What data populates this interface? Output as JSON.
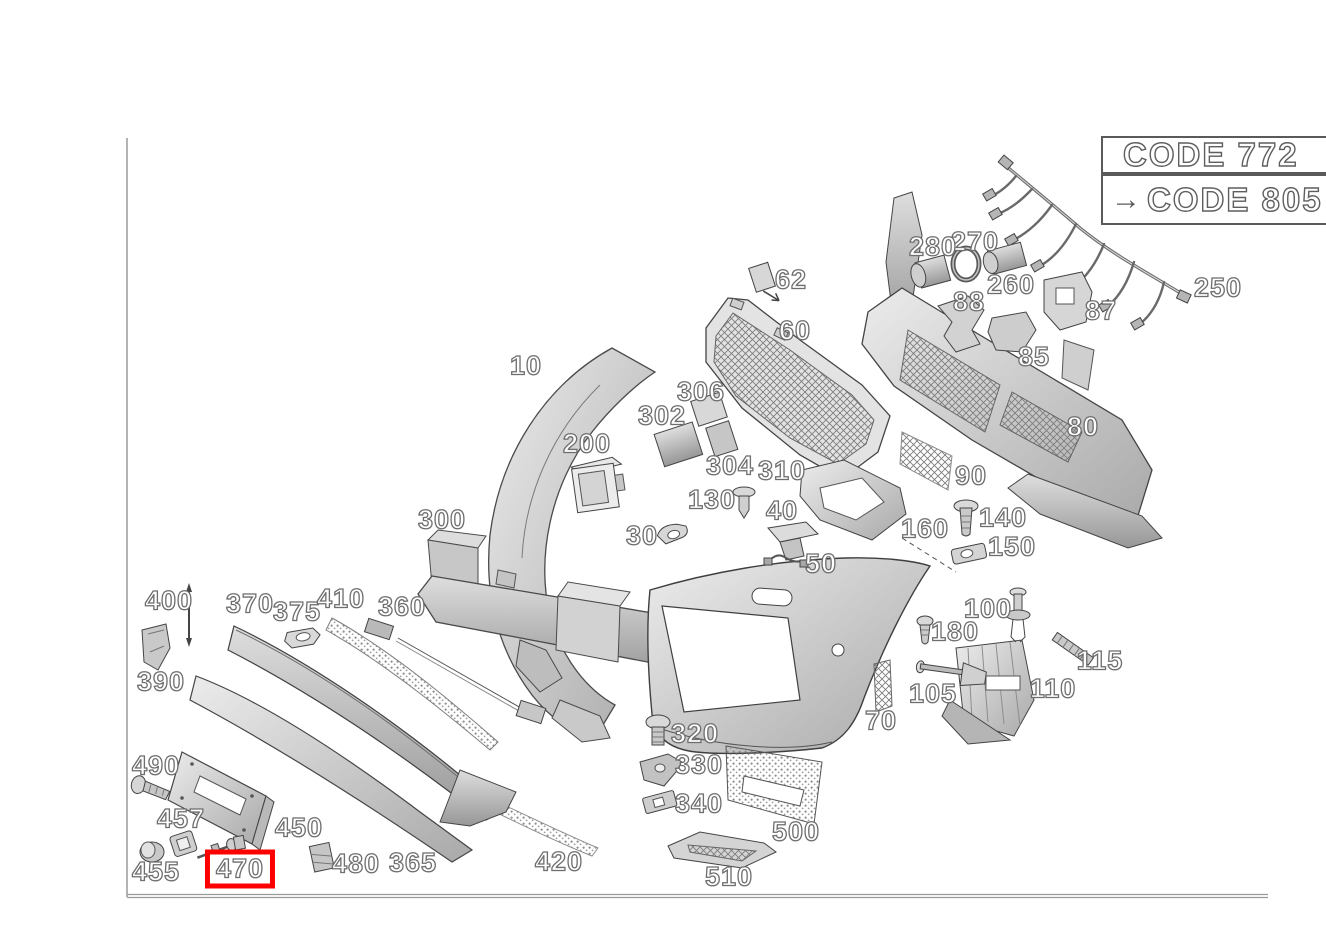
{
  "diagram": {
    "title": "front bumper exploded parts diagram",
    "type": "exploded-parts-diagram",
    "background_color": "#ffffff",
    "label_outline_color": "#6e6e6e",
    "highlight_color": "#ff0000",
    "highlighted_part": "470"
  },
  "code_panel": {
    "arrow_icon": "→",
    "rows": [
      {
        "label": "CODE 772",
        "has_arrow": false
      },
      {
        "label": "CODE 805",
        "has_arrow": true
      }
    ]
  },
  "parts": [
    {
      "id": "10",
      "x": 526,
      "y": 366
    },
    {
      "id": "30",
      "x": 642,
      "y": 536
    },
    {
      "id": "40",
      "x": 782,
      "y": 511
    },
    {
      "id": "50",
      "x": 821,
      "y": 564
    },
    {
      "id": "60",
      "x": 795,
      "y": 331
    },
    {
      "id": "62",
      "x": 791,
      "y": 280
    },
    {
      "id": "70",
      "x": 881,
      "y": 721
    },
    {
      "id": "80",
      "x": 1083,
      "y": 427
    },
    {
      "id": "85",
      "x": 1034,
      "y": 357
    },
    {
      "id": "87",
      "x": 1101,
      "y": 311
    },
    {
      "id": "88",
      "x": 969,
      "y": 302
    },
    {
      "id": "90",
      "x": 971,
      "y": 476
    },
    {
      "id": "100",
      "x": 988,
      "y": 609
    },
    {
      "id": "105",
      "x": 933,
      "y": 694
    },
    {
      "id": "110",
      "x": 1053,
      "y": 689
    },
    {
      "id": "115",
      "x": 1100,
      "y": 661
    },
    {
      "id": "130",
      "x": 712,
      "y": 500
    },
    {
      "id": "140",
      "x": 1003,
      "y": 518
    },
    {
      "id": "150",
      "x": 1012,
      "y": 547
    },
    {
      "id": "160",
      "x": 925,
      "y": 529
    },
    {
      "id": "180",
      "x": 955,
      "y": 632
    },
    {
      "id": "200",
      "x": 587,
      "y": 444
    },
    {
      "id": "250",
      "x": 1218,
      "y": 288
    },
    {
      "id": "260",
      "x": 1011,
      "y": 285
    },
    {
      "id": "270",
      "x": 975,
      "y": 242
    },
    {
      "id": "280",
      "x": 933,
      "y": 247
    },
    {
      "id": "300",
      "x": 442,
      "y": 520
    },
    {
      "id": "302",
      "x": 662,
      "y": 416
    },
    {
      "id": "304",
      "x": 730,
      "y": 466
    },
    {
      "id": "306",
      "x": 701,
      "y": 392
    },
    {
      "id": "310",
      "x": 782,
      "y": 471
    },
    {
      "id": "320",
      "x": 695,
      "y": 734
    },
    {
      "id": "330",
      "x": 699,
      "y": 765
    },
    {
      "id": "340",
      "x": 699,
      "y": 804
    },
    {
      "id": "360",
      "x": 402,
      "y": 607
    },
    {
      "id": "365",
      "x": 413,
      "y": 863
    },
    {
      "id": "370",
      "x": 250,
      "y": 604
    },
    {
      "id": "375",
      "x": 297,
      "y": 612
    },
    {
      "id": "390",
      "x": 161,
      "y": 682
    },
    {
      "id": "400",
      "x": 169,
      "y": 601
    },
    {
      "id": "410",
      "x": 341,
      "y": 599
    },
    {
      "id": "420",
      "x": 559,
      "y": 862
    },
    {
      "id": "450",
      "x": 299,
      "y": 828
    },
    {
      "id": "455",
      "x": 156,
      "y": 872
    },
    {
      "id": "457",
      "x": 181,
      "y": 819
    },
    {
      "id": "470",
      "x": 240,
      "y": 869,
      "highlighted": true
    },
    {
      "id": "480",
      "x": 356,
      "y": 864
    },
    {
      "id": "490",
      "x": 156,
      "y": 766
    },
    {
      "id": "500",
      "x": 796,
      "y": 832
    },
    {
      "id": "510",
      "x": 729,
      "y": 877
    }
  ]
}
